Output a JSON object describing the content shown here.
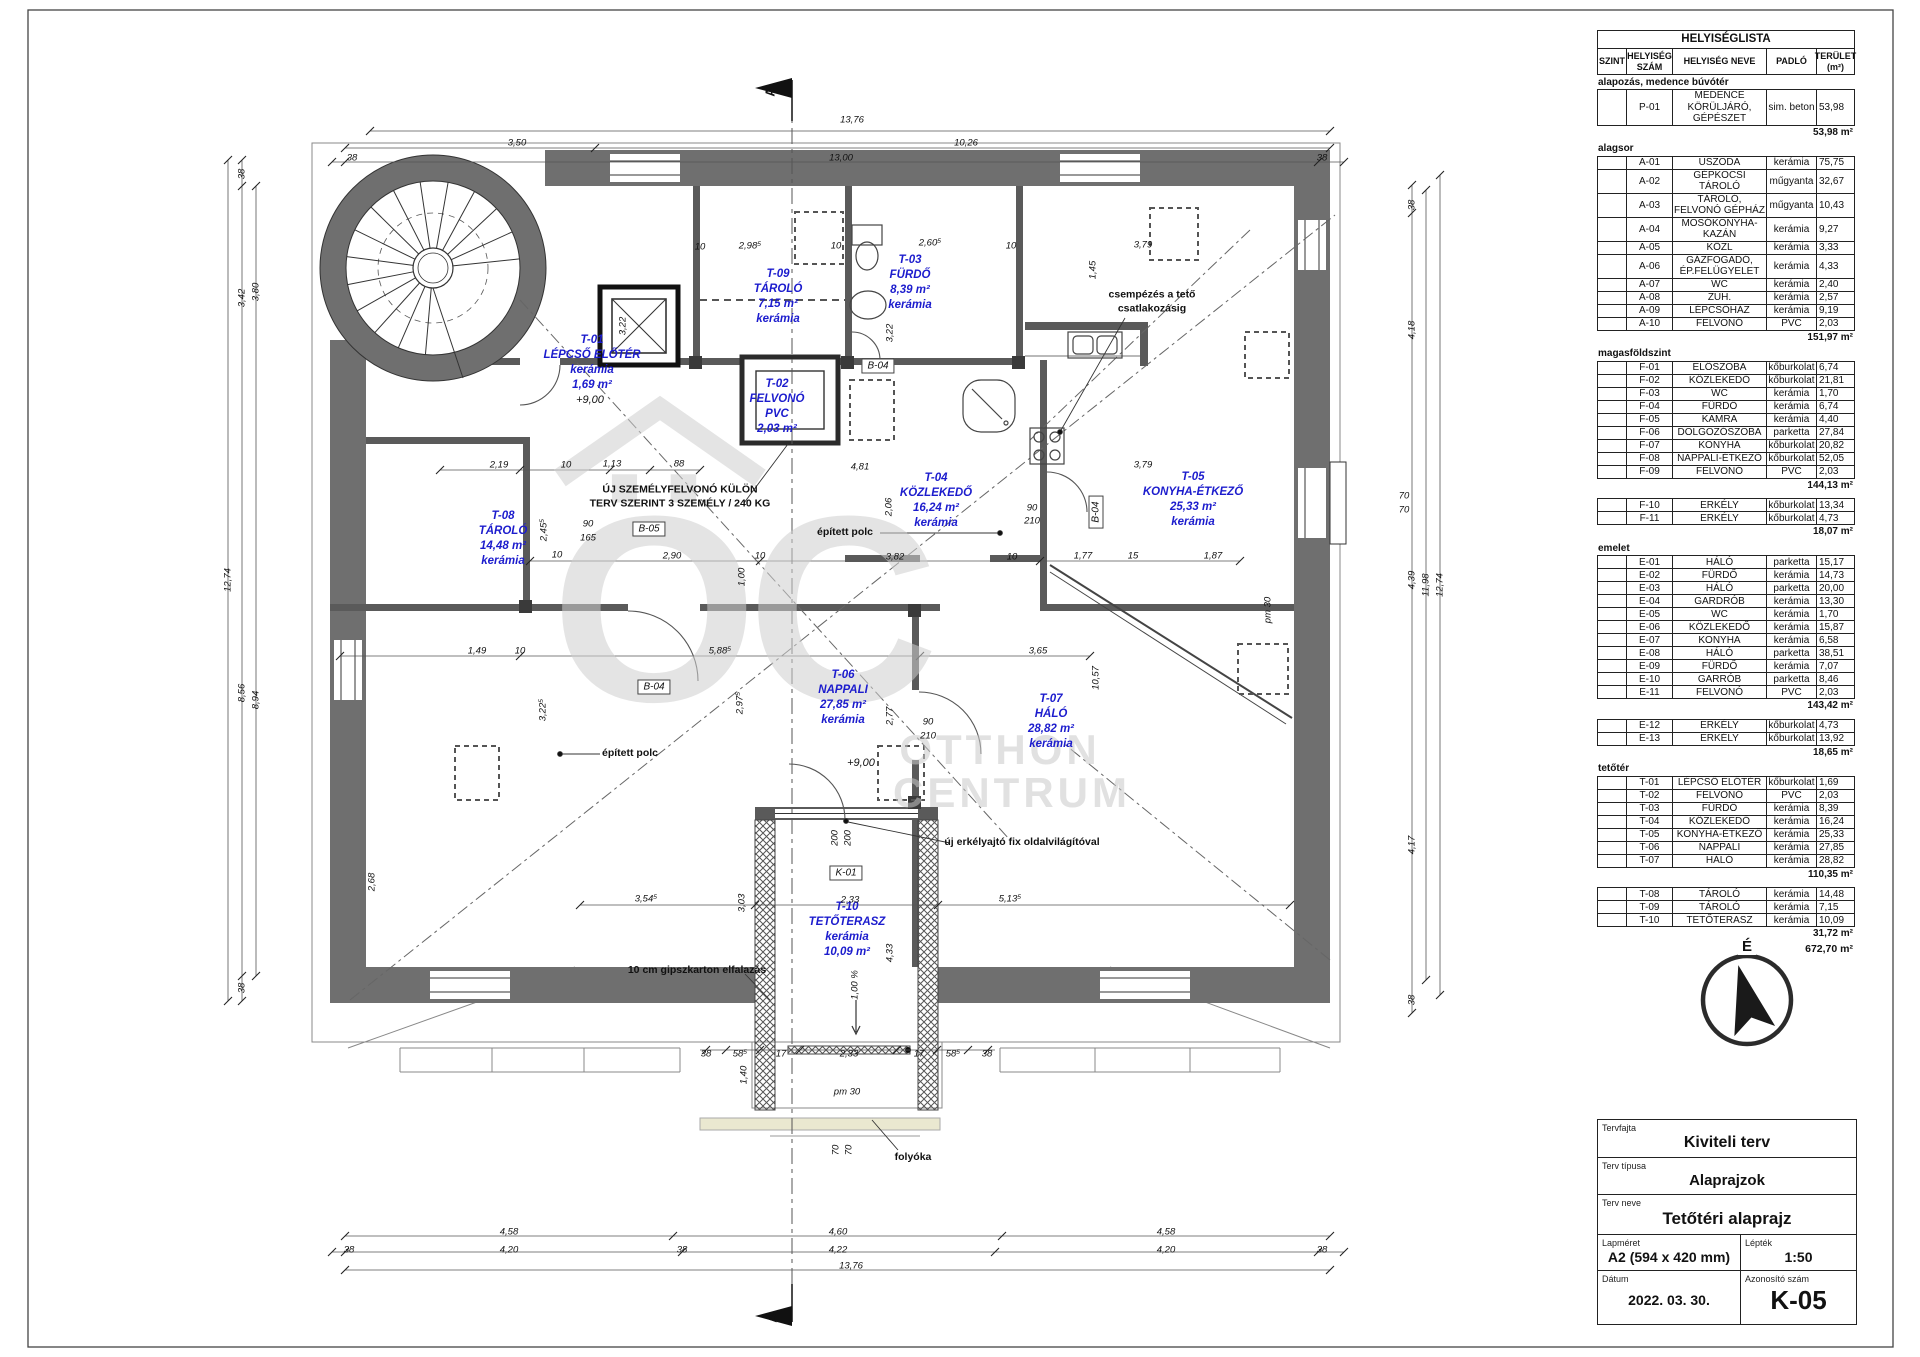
{
  "sheet": {
    "section_mark": "A"
  },
  "watermark": {
    "glyph": "ÖC",
    "line1": "OTTHON",
    "line2": "CENTRUM"
  },
  "north": {
    "label": "É"
  },
  "room_list": {
    "title": "HELYISÉGLISTA",
    "columns": [
      "SZINT",
      "HELYISÉG\nSZÁM",
      "HELYISÉG NEVE",
      "PADLÓ",
      "TERÜLET\n(m²)"
    ],
    "sections": [
      {
        "label": "alapozás, medence búvótér",
        "rows": [
          [
            "",
            "P-01",
            "MEDENCE KÖRÜLJÁRÓ, GÉPÉSZET",
            "sim. beton",
            "53,98"
          ]
        ],
        "subtotal": "53,98 m²"
      },
      {
        "label": "alagsor",
        "rows": [
          [
            "",
            "A-01",
            "USZODA",
            "kerámia",
            "75,75"
          ],
          [
            "",
            "A-02",
            "GÉPKOCSI TÁROLÓ",
            "műgyanta",
            "32,67"
          ],
          [
            "",
            "A-03",
            "TÁROLÓ, FELVONÓ GÉPHÁZ",
            "műgyanta",
            "10,43"
          ],
          [
            "",
            "A-04",
            "MOSÓKONYHA-KAZÁN",
            "kerámia",
            "9,27"
          ],
          [
            "",
            "A-05",
            "KÖZL",
            "kerámia",
            "3,33"
          ],
          [
            "",
            "A-06",
            "GÁZFOGADÓ, ÉP.FELÜGYELET",
            "kerámia",
            "4,33"
          ],
          [
            "",
            "A-07",
            "WC",
            "kerámia",
            "2,40"
          ],
          [
            "",
            "A-08",
            "ZUH.",
            "kerámia",
            "2,57"
          ],
          [
            "",
            "A-09",
            "LÉPCSŐHÁZ",
            "kerámia",
            "9,19"
          ],
          [
            "",
            "A-10",
            "FELVONÓ",
            "PVC",
            "2,03"
          ]
        ],
        "subtotal": "151,97 m²"
      },
      {
        "label": "magasföldszint",
        "rows": [
          [
            "",
            "F-01",
            "ELŐSZOBA",
            "kőburkolat",
            "6,74"
          ],
          [
            "",
            "F-02",
            "KÖZLEKEDŐ",
            "kőburkolat",
            "21,81"
          ],
          [
            "",
            "F-03",
            "WC",
            "kerámia",
            "1,70"
          ],
          [
            "",
            "F-04",
            "FÜRDŐ",
            "kerámia",
            "6,74"
          ],
          [
            "",
            "F-05",
            "KAMRA",
            "kerámia",
            "4,40"
          ],
          [
            "",
            "F-06",
            "DOLGOZÓSZOBA",
            "parketta",
            "27,84"
          ],
          [
            "",
            "F-07",
            "KONYHA",
            "kőburkolat",
            "20,82"
          ],
          [
            "",
            "F-08",
            "NAPPALI-ÉTKEZŐ",
            "kőburkolat",
            "52,05"
          ],
          [
            "",
            "F-09",
            "FELVONÓ",
            "PVC",
            "2,03"
          ]
        ],
        "subtotal": "144,13 m²"
      },
      {
        "label": "",
        "rows": [
          [
            "",
            "F-10",
            "ERKÉLY",
            "kőburkolat",
            "13,34"
          ],
          [
            "",
            "F-11",
            "ERKÉLY",
            "kőburkolat",
            "4,73"
          ]
        ],
        "subtotal": "18,07 m²"
      },
      {
        "label": "emelet",
        "rows": [
          [
            "",
            "E-01",
            "HÁLÓ",
            "parketta",
            "15,17"
          ],
          [
            "",
            "E-02",
            "FÜRDŐ",
            "kerámia",
            "14,73"
          ],
          [
            "",
            "E-03",
            "HÁLÓ",
            "parketta",
            "20,00"
          ],
          [
            "",
            "E-04",
            "GARDRÓB",
            "kerámia",
            "13,30"
          ],
          [
            "",
            "E-05",
            "WC",
            "kerámia",
            "1,70"
          ],
          [
            "",
            "E-06",
            "KÖZLEKEDŐ",
            "kerámia",
            "15,87"
          ],
          [
            "",
            "E-07",
            "KONYHA",
            "kerámia",
            "6,58"
          ],
          [
            "",
            "E-08",
            "HÁLÓ",
            "parketta",
            "38,51"
          ],
          [
            "",
            "E-09",
            "FÜRDŐ",
            "kerámia",
            "7,07"
          ],
          [
            "",
            "E-10",
            "GARRÓB",
            "parketta",
            "8,46"
          ],
          [
            "",
            "E-11",
            "FELVONÓ",
            "PVC",
            "2,03"
          ]
        ],
        "subtotal": "143,42 m²"
      },
      {
        "label": "",
        "rows": [
          [
            "",
            "E-12",
            "ERKÉLY",
            "kőburkolat",
            "4,73"
          ],
          [
            "",
            "E-13",
            "ERKÉLY",
            "kőburkolat",
            "13,92"
          ]
        ],
        "subtotal": "18,65 m²"
      },
      {
        "label": "tetőtér",
        "rows": [
          [
            "",
            "T-01",
            "LÉPCSŐ ELŐTÉR",
            "kőburkolat",
            "1,69"
          ],
          [
            "",
            "T-02",
            "FELVONÓ",
            "PVC",
            "2,03"
          ],
          [
            "",
            "T-03",
            "FÜRDŐ",
            "kerámia",
            "8,39"
          ],
          [
            "",
            "T-04",
            "KÖZLEKEDŐ",
            "kerámia",
            "16,24"
          ],
          [
            "",
            "T-05",
            "KONYHA-ÉTKEZŐ",
            "kerámia",
            "25,33"
          ],
          [
            "",
            "T-06",
            "NAPPALI",
            "kerámia",
            "27,85"
          ],
          [
            "",
            "T-07",
            "HÁLÓ",
            "kerámia",
            "28,82"
          ]
        ],
        "subtotal": "110,35 m²"
      },
      {
        "label": "",
        "rows": [
          [
            "",
            "T-08",
            "TÁROLÓ",
            "kerámia",
            "14,48"
          ],
          [
            "",
            "T-09",
            "TÁROLÓ",
            "kerámia",
            "7,15"
          ],
          [
            "",
            "T-10",
            "TETŐTERASZ",
            "kerámia",
            "10,09"
          ]
        ],
        "subtotal": "31,72 m²"
      }
    ],
    "grand_total": "672,70 m²"
  },
  "title_block": {
    "tervfajta_label": "Tervfajta",
    "tervfajta": "Kiviteli terv",
    "tipus_label": "Terv típusa",
    "tipus": "Alaprajzok",
    "neve_label": "Terv neve",
    "neve": "Tetőtéri alaprajz",
    "lapmeret_label": "Lapméret",
    "lapmeret": "A2 (594 x 420 mm)",
    "leptek_label": "Lépték",
    "leptek": "1:50",
    "datum_label": "Dátum",
    "datum": "2022. 03. 30.",
    "azonosito_label": "Azonosító szám",
    "azonosito": "K-05"
  },
  "plan": {
    "rooms": [
      {
        "x": 592,
        "y": 363,
        "lines": [
          "T-01",
          "LÉPCSŐ ELŐTÉR",
          "kerámia",
          "1,69 m²"
        ]
      },
      {
        "x": 778,
        "y": 297,
        "lines": [
          "T-09",
          "TÁROLÓ",
          "7,15 m²",
          "kerámia"
        ]
      },
      {
        "x": 777,
        "y": 407,
        "lines": [
          "T-02",
          "FELVONÓ",
          "PVC",
          "2,03 m²"
        ]
      },
      {
        "x": 910,
        "y": 283,
        "lines": [
          "T-03",
          "FÜRDŐ",
          "8,39 m²",
          "kerámia"
        ]
      },
      {
        "x": 936,
        "y": 501,
        "lines": [
          "T-04",
          "KÖZLEKEDŐ",
          "16,24 m²",
          "kerámia"
        ]
      },
      {
        "x": 1193,
        "y": 500,
        "lines": [
          "T-05",
          "KONYHA-ÉTKEZŐ",
          "25,33 m²",
          "kerámia"
        ]
      },
      {
        "x": 503,
        "y": 539,
        "lines": [
          "T-08",
          "TÁROLÓ",
          "14,48 m²",
          "kerámia"
        ]
      },
      {
        "x": 843,
        "y": 698,
        "lines": [
          "T-06",
          "NAPPALI",
          "27,85 m²",
          "kerámia"
        ]
      },
      {
        "x": 1051,
        "y": 722,
        "lines": [
          "T-07",
          "HÁLÓ",
          "28,82 m²",
          "kerámia"
        ]
      },
      {
        "x": 847,
        "y": 930,
        "lines": [
          "T-10",
          "TETŐTERASZ",
          "kerámia",
          "10,09 m²"
        ]
      }
    ],
    "annotations": [
      {
        "t": "ÚJ SZEMÉLYFELVONÓ KÜLÖN\nTERV SZERINT 3 SZEMÉLY / 240 KG",
        "x": 680,
        "y": 497
      },
      {
        "t": "csempézés a tető\ncsatlakozásig",
        "x": 1152,
        "y": 302
      },
      {
        "t": "épített polc",
        "x": 845,
        "y": 533
      },
      {
        "t": "épített polc",
        "x": 630,
        "y": 754
      },
      {
        "t": "10 cm gipszkarton elfalazás",
        "x": 697,
        "y": 971
      },
      {
        "t": "új erkélyajtó fix oldalvilágítóval",
        "x": 1022,
        "y": 843
      },
      {
        "t": "folyóka",
        "x": 913,
        "y": 1158
      }
    ],
    "level_marks": [
      {
        "t": "+9,00",
        "x": 590,
        "y": 400
      },
      {
        "t": "+9,00",
        "x": 861,
        "y": 763
      }
    ],
    "ref_boxes": [
      {
        "t": "B-05",
        "x": 649,
        "y": 529,
        "r": 0
      },
      {
        "t": "B-04",
        "x": 878,
        "y": 366,
        "r": 0
      },
      {
        "t": "B-04",
        "x": 654,
        "y": 687,
        "r": 0
      },
      {
        "t": "B-04",
        "x": 1096,
        "y": 512,
        "r": -90
      },
      {
        "t": "K-01",
        "x": 846,
        "y": 873,
        "r": 0
      }
    ],
    "dims": [
      [
        "13,76",
        852,
        120,
        0
      ],
      [
        "3,50",
        517,
        143,
        0
      ],
      [
        "10,26",
        966,
        143,
        0
      ],
      [
        "38",
        352,
        158,
        0
      ],
      [
        "13,00",
        841,
        158,
        0
      ],
      [
        "38",
        1322,
        158,
        0
      ],
      [
        "2,98⁵",
        750,
        246,
        0
      ],
      [
        "10",
        700,
        247,
        0
      ],
      [
        "10",
        836,
        246,
        0
      ],
      [
        "2,60⁵",
        930,
        243,
        0
      ],
      [
        "10",
        1011,
        246,
        0
      ],
      [
        "3,79",
        1143,
        245,
        0
      ],
      [
        "3,79",
        1143,
        465,
        0
      ],
      [
        "1,45",
        1093,
        270,
        -90
      ],
      [
        "3,22",
        890,
        333,
        -90
      ],
      [
        "3,22",
        623,
        326,
        -90
      ],
      [
        "38",
        242,
        174,
        -90
      ],
      [
        "3,42",
        242,
        298,
        -90
      ],
      [
        "8,56",
        242,
        693,
        -90
      ],
      [
        "3,80",
        256,
        292,
        -90
      ],
      [
        "8,94",
        256,
        700,
        -90
      ],
      [
        "12,74",
        228,
        580,
        -90
      ],
      [
        "38",
        242,
        988,
        -90
      ],
      [
        "38",
        1412,
        205,
        -90
      ],
      [
        "4,18",
        1412,
        330,
        -90
      ],
      [
        "4,39",
        1412,
        580,
        -90
      ],
      [
        "4,17",
        1412,
        845,
        -90
      ],
      [
        "38",
        1412,
        1000,
        -90
      ],
      [
        "11,98",
        1426,
        585,
        -90
      ],
      [
        "12,74",
        1440,
        585,
        -90
      ],
      [
        "70",
        1404,
        496,
        0
      ],
      [
        "70",
        1404,
        510,
        0
      ],
      [
        "pm 30",
        1268,
        610,
        -90
      ],
      [
        "2,19",
        499,
        465,
        0
      ],
      [
        "10",
        566,
        465,
        0
      ],
      [
        "1,13",
        612,
        464,
        0
      ],
      [
        "88",
        679,
        464,
        0
      ],
      [
        "2,45⁵",
        544,
        530,
        -90
      ],
      [
        "90",
        588,
        524,
        0
      ],
      [
        "165",
        588,
        538,
        0
      ],
      [
        "10",
        557,
        555,
        0
      ],
      [
        "2,90",
        672,
        556,
        0
      ],
      [
        "10",
        760,
        556,
        0
      ],
      [
        "3,82",
        895,
        557,
        0
      ],
      [
        "10",
        1012,
        557,
        0
      ],
      [
        "1,77",
        1083,
        556,
        0
      ],
      [
        "15",
        1133,
        556,
        0
      ],
      [
        "1,87",
        1213,
        556,
        0
      ],
      [
        "4,81",
        860,
        467,
        0
      ],
      [
        "2,06",
        889,
        507,
        -90
      ],
      [
        "90",
        1032,
        508,
        0
      ],
      [
        "210",
        1032,
        521,
        0
      ],
      [
        "1,00",
        742,
        577,
        -90
      ],
      [
        "3,22⁵",
        543,
        710,
        -90
      ],
      [
        "1,49",
        477,
        651,
        0
      ],
      [
        "10",
        520,
        651,
        0
      ],
      [
        "5,88⁵",
        720,
        651,
        0
      ],
      [
        "3,65",
        1038,
        651,
        0
      ],
      [
        "10,57",
        1096,
        678,
        -90
      ],
      [
        "2,97⁵",
        740,
        703,
        -90
      ],
      [
        "2,77",
        890,
        716,
        -90
      ],
      [
        "90",
        928,
        722,
        0
      ],
      [
        "210",
        928,
        736,
        0
      ],
      [
        "2,68",
        372,
        882,
        -90
      ],
      [
        "3,54⁵",
        646,
        899,
        0
      ],
      [
        "3,03",
        742,
        903,
        -90
      ],
      [
        "2,33",
        850,
        900,
        0
      ],
      [
        "5,13⁵",
        1010,
        899,
        0
      ],
      [
        "200",
        835,
        838,
        -90
      ],
      [
        "200",
        848,
        838,
        -90
      ],
      [
        "4,33",
        890,
        953,
        -90
      ],
      [
        "1,00 %",
        855,
        985,
        -90
      ],
      [
        "38",
        706,
        1054,
        0
      ],
      [
        "58⁵",
        740,
        1054,
        0
      ],
      [
        "17",
        781,
        1054,
        0
      ],
      [
        "2,33",
        849,
        1054,
        0
      ],
      [
        "17",
        919,
        1054,
        0
      ],
      [
        "58⁵",
        953,
        1054,
        0
      ],
      [
        "38",
        987,
        1054,
        0
      ],
      [
        "1,40",
        744,
        1075,
        -90
      ],
      [
        "pm 30",
        847,
        1092,
        0
      ],
      [
        "70",
        836,
        1150,
        -90
      ],
      [
        "70",
        849,
        1150,
        -90
      ],
      [
        "4,58",
        509,
        1232,
        0
      ],
      [
        "4,60",
        838,
        1232,
        0
      ],
      [
        "4,58",
        1166,
        1232,
        0
      ],
      [
        "38",
        349,
        1250,
        0
      ],
      [
        "4,20",
        509,
        1250,
        0
      ],
      [
        "38",
        682,
        1250,
        0
      ],
      [
        "4,22",
        838,
        1250,
        0
      ],
      [
        "4,20",
        1166,
        1250,
        0
      ],
      [
        "38",
        1322,
        1250,
        0
      ],
      [
        "13,76",
        851,
        1266,
        0
      ]
    ]
  }
}
